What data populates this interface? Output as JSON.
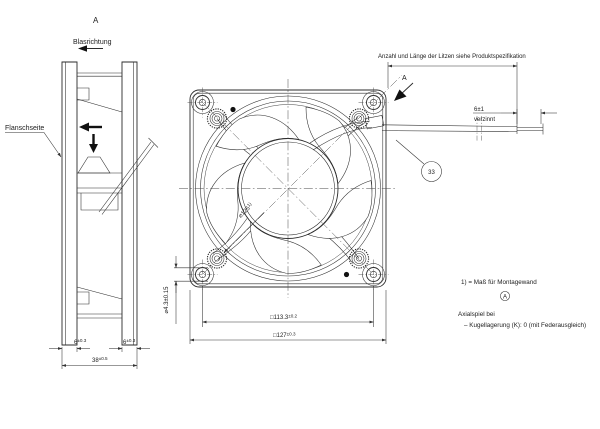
{
  "drawing": {
    "title_view_label": "A",
    "blow_direction": "Blasrichtung",
    "flange_side": "Flanschseite",
    "litzen_note": "Anzahl und Länge der Litzen siehe Produktspezifikation",
    "view_arrow": "A",
    "balloon_number": "33",
    "wire_end_length": "6±1",
    "wire_end_finish": "verzinnt",
    "dims": {
      "flange_left_value": "6",
      "flange_left_tol": "±0.3",
      "flange_right_value": "6",
      "flange_right_tol": "±0.3",
      "depth_value": "38",
      "depth_tol": "±0.5",
      "mounting_hole_dia": "⌀4.3±0.15",
      "hole_spacing_value": "□113.3",
      "hole_spacing_tol": "±0.2",
      "frame_value": "□127",
      "frame_tol": "±0.3",
      "inlet_dia_value": "⌀125",
      "inlet_dia_sup": "1)"
    },
    "notes": {
      "montagewand": "1) = Maß für Montagewand",
      "circled_letter": "A",
      "axial_line1": "Axialspiel bei",
      "axial_line2": "–  Kugellagerung (K): 0 (mit Federausgleich)"
    },
    "colors": {
      "line": "#2b2b2b",
      "background": "#ffffff"
    }
  }
}
